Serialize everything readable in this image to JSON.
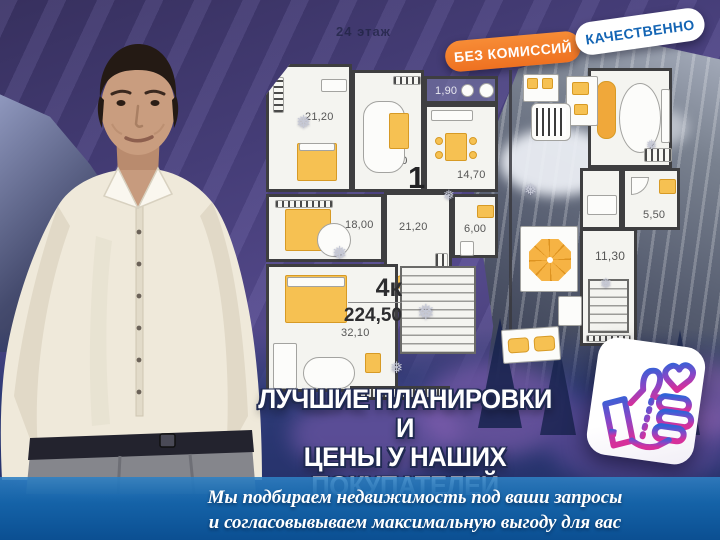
{
  "scene": {
    "floor_label": "24 этаж"
  },
  "badges": {
    "no_commission": "БЕЗ КОМИССИЙ",
    "quality": "КАЧЕСТВЕННО"
  },
  "floorplan": {
    "unit_label": "4к",
    "unit_area": "224,50",
    "plan_number": "1",
    "rooms": [
      {
        "name": "bedroom-top-left",
        "area": "21,20"
      },
      {
        "name": "bedroom-top-mid",
        "area": "13,80"
      },
      {
        "name": "balcony",
        "area": "1,90"
      },
      {
        "name": "kitchen",
        "area": "14,70"
      },
      {
        "name": "bedroom-left",
        "area": "18,00"
      },
      {
        "name": "hallway",
        "area": "21,20"
      },
      {
        "name": "bathroom",
        "area": "6,00"
      },
      {
        "name": "living-room",
        "area": "32,10"
      },
      {
        "name": "right-living",
        "area": "21,00"
      },
      {
        "name": "right-bathroom",
        "area": "5,50"
      },
      {
        "name": "right-hall",
        "area": "11,30"
      }
    ]
  },
  "headline": {
    "line1": "ЛУЧШИЕ ПЛАНИРОВКИ И",
    "line2": "ЦЕНЫ У НАШИХ",
    "line3": "ПОКУПАТЕЛЕЙ"
  },
  "footer": {
    "line1": "Мы подбираем  недвижимость под ваши запросы",
    "line2": "и согласовывываем максимальную выгоду для вас"
  },
  "icons": {
    "like": "thumbs-up-heart-icon"
  },
  "colors": {
    "badge_orange": "#f07b28",
    "badge_text_blue": "#1465b4",
    "furniture_yellow": "#f6c152",
    "footer_blue_top": "#2e80c4",
    "footer_blue_bottom": "#0b4f92",
    "icon_gradient_start": "#2f63d8",
    "icon_gradient_end": "#d6309b"
  }
}
